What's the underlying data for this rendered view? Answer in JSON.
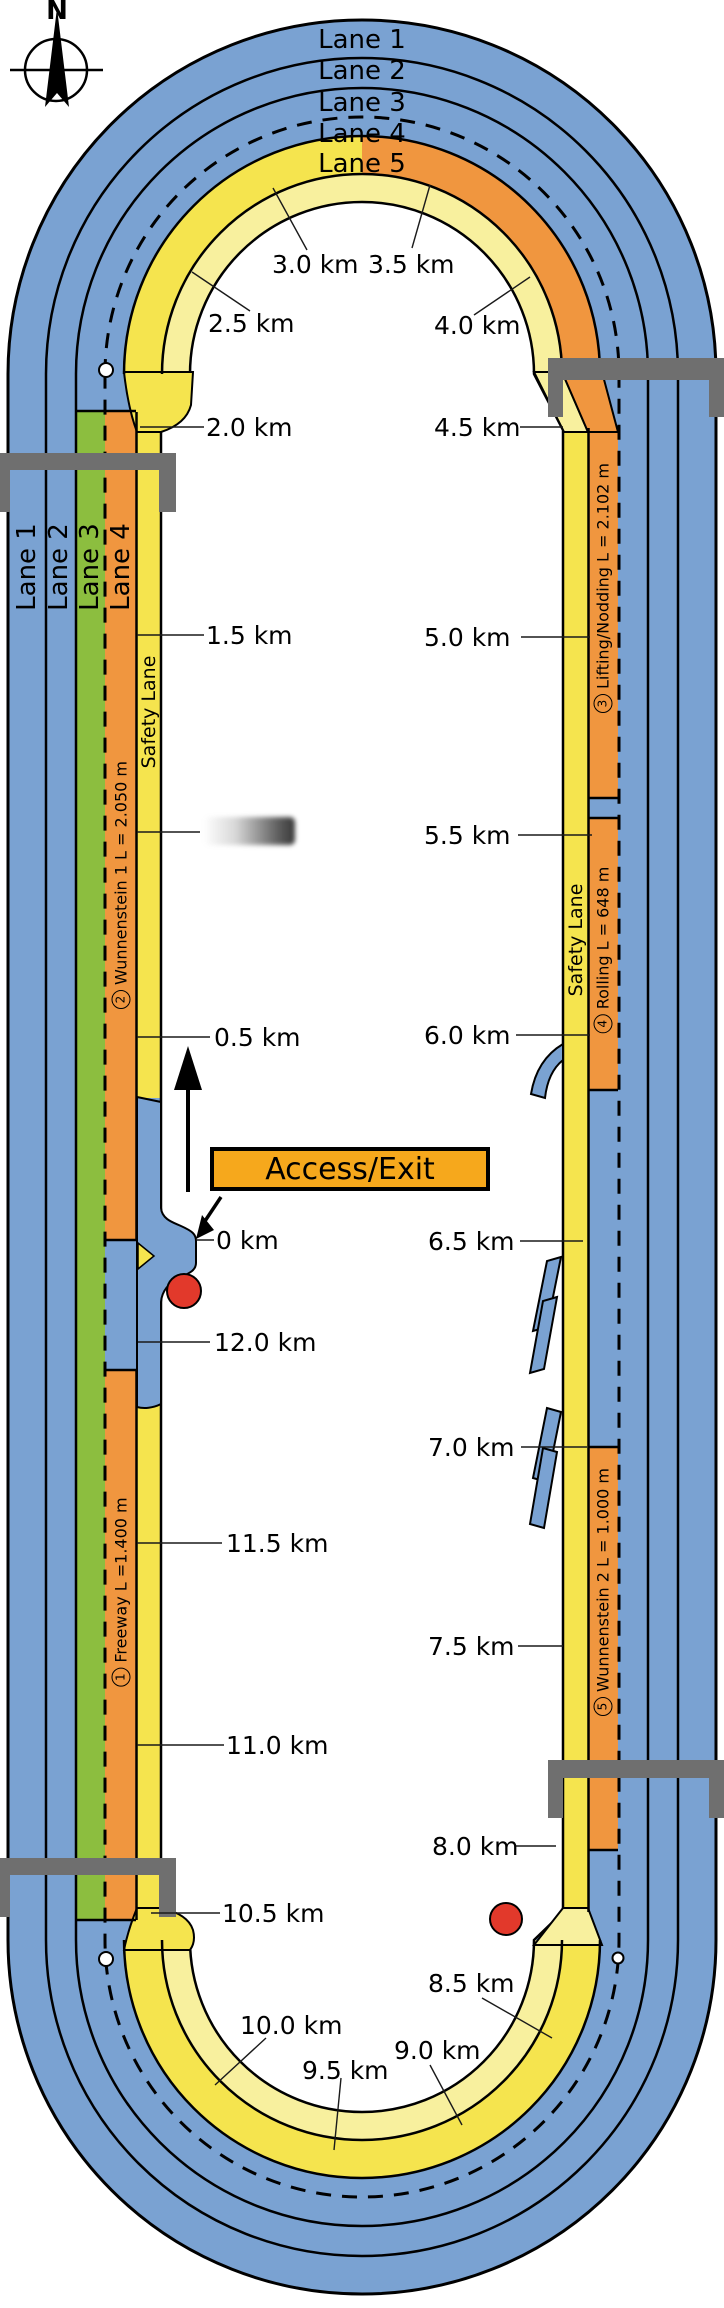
{
  "compass": {
    "north": "N"
  },
  "track": {
    "curve_lane_labels": [
      "Lane 1",
      "Lane 2",
      "Lane 3",
      "Lane 4",
      "Lane 5"
    ],
    "left_lane_labels": [
      "Lane 1",
      "Lane 2",
      "Lane 3",
      "Lane 4"
    ],
    "safety_lane_left": "Safety Lane",
    "safety_lane_right": "Safety Lane"
  },
  "segments": {
    "freeway": {
      "num": "1",
      "label": "Freeway L =1.400 m"
    },
    "wunnenstein1": {
      "num": "2",
      "label": "Wunnenstein 1  L = 2.050 m"
    },
    "lifting_nodding": {
      "num": "3",
      "label": "Lifting/Nodding L = 2.102 m"
    },
    "rolling": {
      "num": "4",
      "label": "Rolling L = 648 m"
    },
    "wunnenstein2": {
      "num": "5",
      "label": "Wunnenstein 2 L = 1.000 m"
    }
  },
  "access": {
    "label": "Access/Exit"
  },
  "km": {
    "k00": "0 km",
    "k05": "0.5 km",
    "k15": "1.5 km",
    "k20": "2.0 km",
    "k25": "2.5 km",
    "k30": "3.0 km",
    "k35": "3.5 km",
    "k40": "4.0 km",
    "k45": "4.5 km",
    "k50": "5.0 km",
    "k55": "5.5 km",
    "k60": "6.0 km",
    "k65": "6.5 km",
    "k70": "7.0 km",
    "k75": "7.5 km",
    "k80": "8.0 km",
    "k85": "8.5 km",
    "k90": "9.0 km",
    "k95": "9.5 km",
    "k100": "10.0 km",
    "k105": "10.5 km",
    "k110": "11.0 km",
    "k115": "11.5 km",
    "k120": "12.0 km"
  },
  "colors": {
    "lane_blue": "#7aa2d2",
    "lane5_yellow": "#f5e44e",
    "safety_yellow": "#f8f09e",
    "lane3_green": "#8cbe3f",
    "segment_orange": "#f0963f",
    "access_box_orange": "#f6a81c",
    "bridge_gray": "#6f6f6f",
    "marker_red": "#e2392b"
  }
}
